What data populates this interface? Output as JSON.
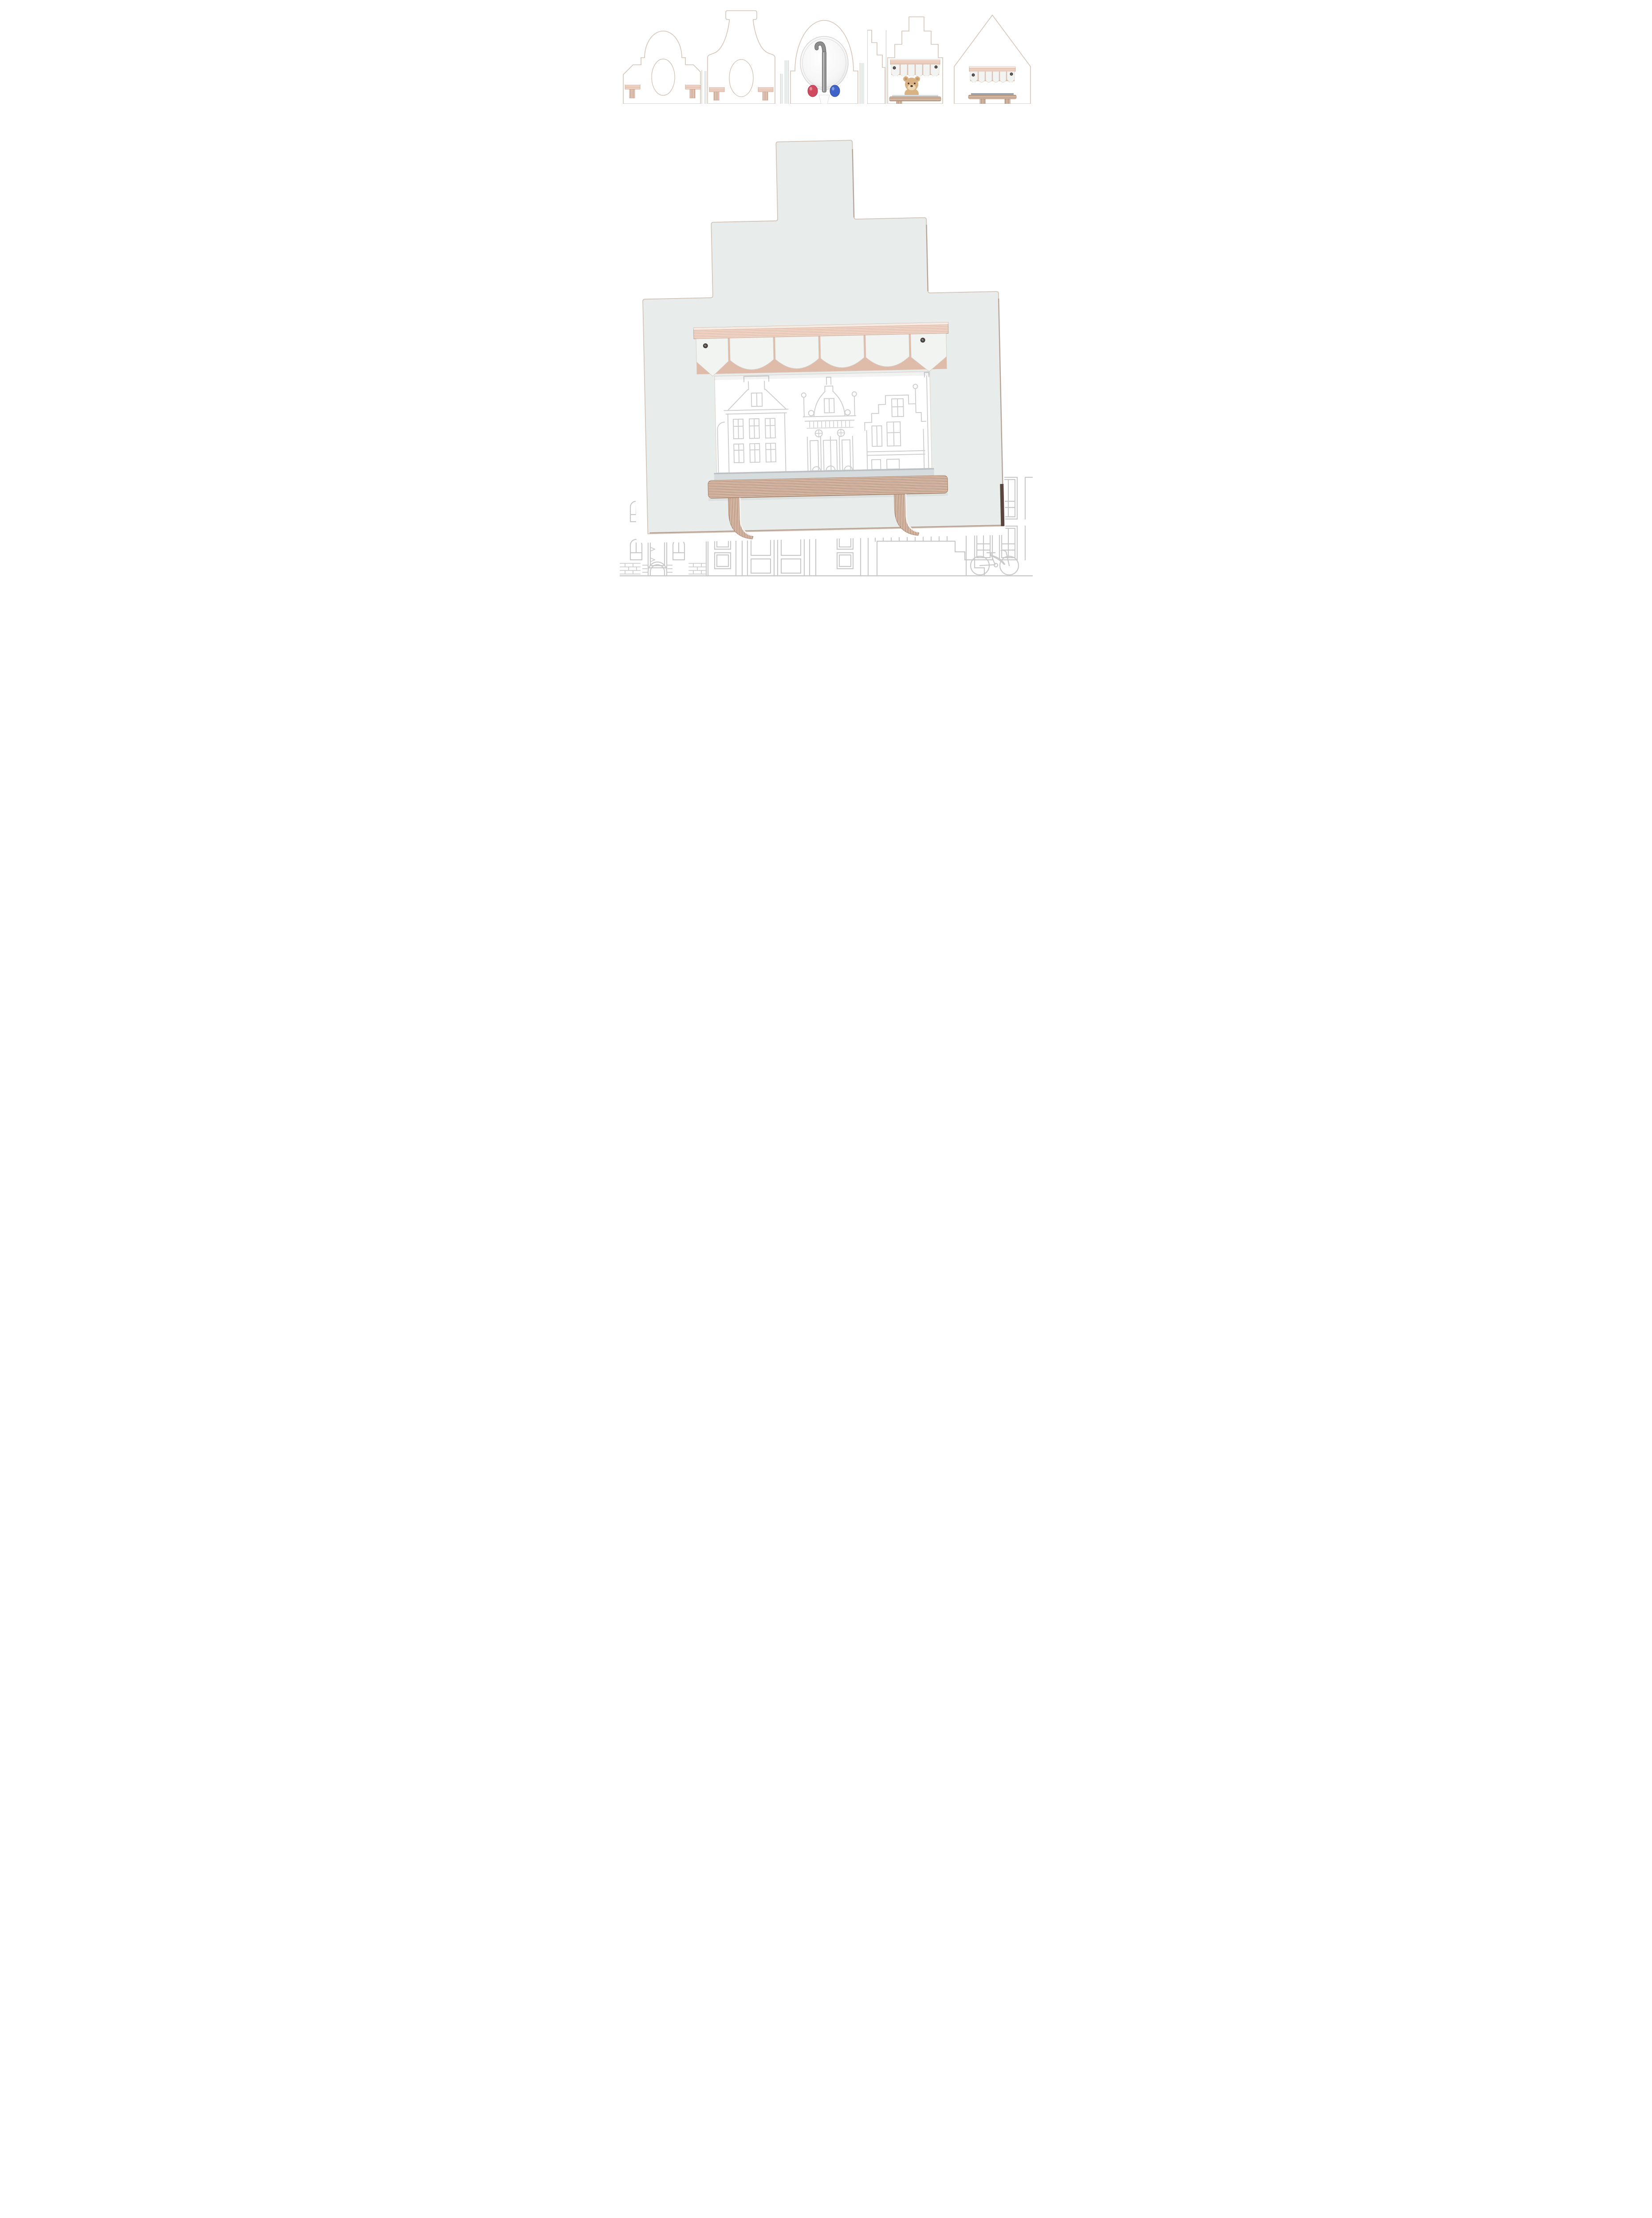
{
  "page": {
    "background": "#ffffff"
  },
  "colors": {
    "panel": "#e8edeb",
    "panel_edge": "#d3c4b7",
    "panel_edge_dark": "#b7a294",
    "panel_side_dark": "#5a463e",
    "wood_rail": "#ecccbc",
    "wood_shelf": "#cdab98",
    "valance_white": "#f2f4f2",
    "valance_backing": "#dfbcaa",
    "shelf_top": "#d6dbde",
    "shelf_top_dark": "#9aa1a7",
    "screw": "#45403d",
    "lineart": "#c9c9c9",
    "lineart_window": "#cdcdcd",
    "mirror_ring": "#dcdcdc",
    "hook_metal": "#8e8e8e",
    "knob_red": "#cf4a5e",
    "knob_blue": "#3f63c8",
    "teddy": "#d9b283",
    "teddy_ear": "#c49a6d",
    "teddy_muzzle": "#eed7b4",
    "teddy_dark": "#4a3526"
  },
  "gallery": {
    "items": [
      {
        "id": "thumb-1",
        "label": "bell-gable house panel with oval cutout and two peg shelves"
      },
      {
        "id": "thumb-2",
        "label": "neck-gable house panel with oval cutout and peg shelves"
      },
      {
        "id": "thumb-3",
        "label": "arched house panel with round mirror and coat hook with red and blue knobs"
      },
      {
        "id": "thumb-4",
        "label": "stepped-gable house panel with scalloped awning, shelf and teddy bear"
      },
      {
        "id": "thumb-5",
        "label": "pitched-roof house panel with scalloped awning and shelf"
      }
    ]
  },
  "main_image": {
    "label": "stepped-gable house wall panel with scalloped awning, window opening and plywood shelf"
  },
  "backdrop": {
    "label": "canal houses line illustration with bicycle"
  }
}
